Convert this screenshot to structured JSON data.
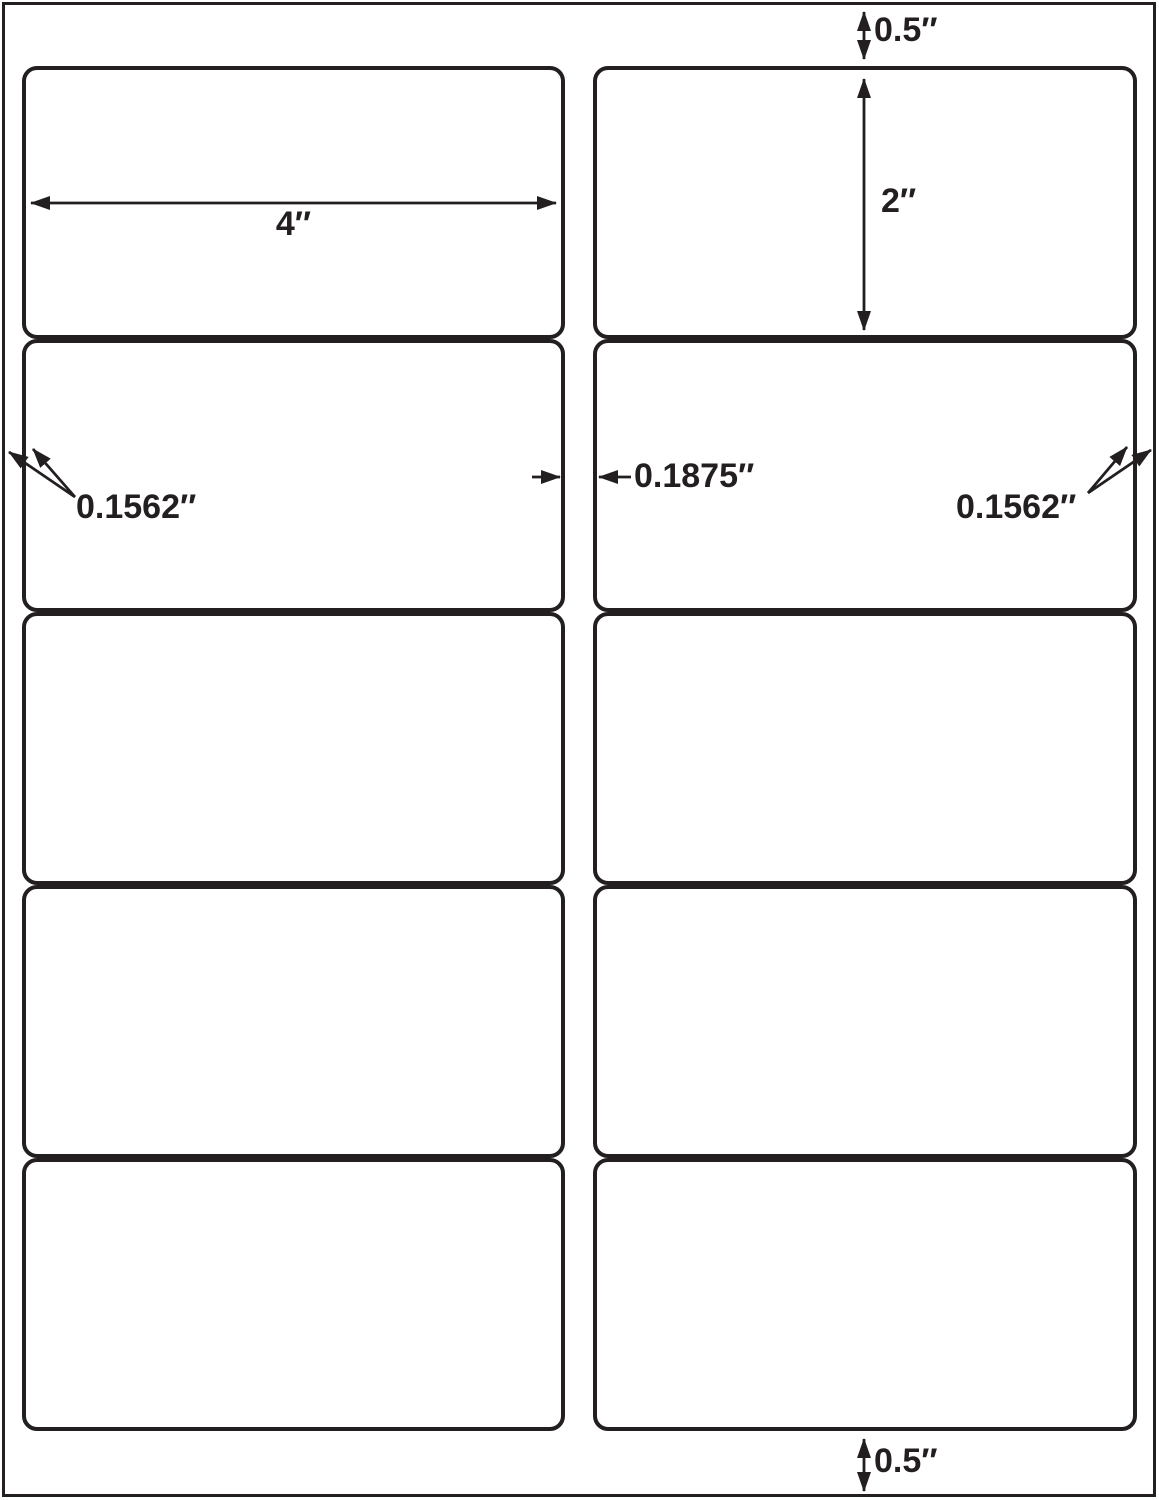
{
  "page": {
    "background": "#ffffff",
    "ink": "#231f20",
    "description": "Blank label sheet template diagram"
  },
  "sheet": {
    "rows": 5,
    "columns": 2,
    "labels_count": 10
  },
  "annotations": {
    "top_margin": {
      "value": "0.5″"
    },
    "bottom_margin": {
      "value": "0.5″"
    },
    "label_width": {
      "value": "4″"
    },
    "label_height": {
      "value": "2″"
    },
    "left_margin": {
      "value": "0.1562″"
    },
    "right_margin": {
      "value": "0.1562″"
    },
    "column_gap": {
      "value": "0.1875″"
    }
  }
}
